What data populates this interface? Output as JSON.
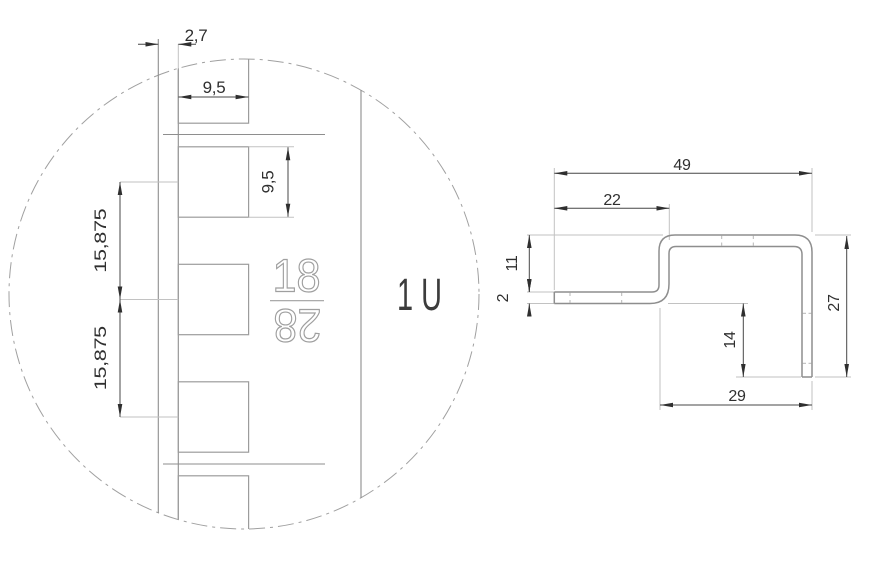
{
  "drawing": {
    "detail": {
      "edge_offset": "2,7",
      "hole_width": "9,5",
      "hole_height": "9,5",
      "pitch_top": "15,875",
      "pitch_bottom": "15,875",
      "stamp_top": "18",
      "stamp_bottom": "28",
      "unit_label": "1 U"
    },
    "profile": {
      "overall_width": "49",
      "front_flange": "22",
      "step_height": "11",
      "thickness": "2",
      "leg_inner": "14",
      "leg_depth": "27",
      "rear_width": "29"
    },
    "colors": {
      "background": "#ffffff",
      "structure_line": "#8e8e8e",
      "dimension_line": "#474747",
      "extension_line": "#c2c2c2",
      "text": "#2f2f2f"
    }
  }
}
